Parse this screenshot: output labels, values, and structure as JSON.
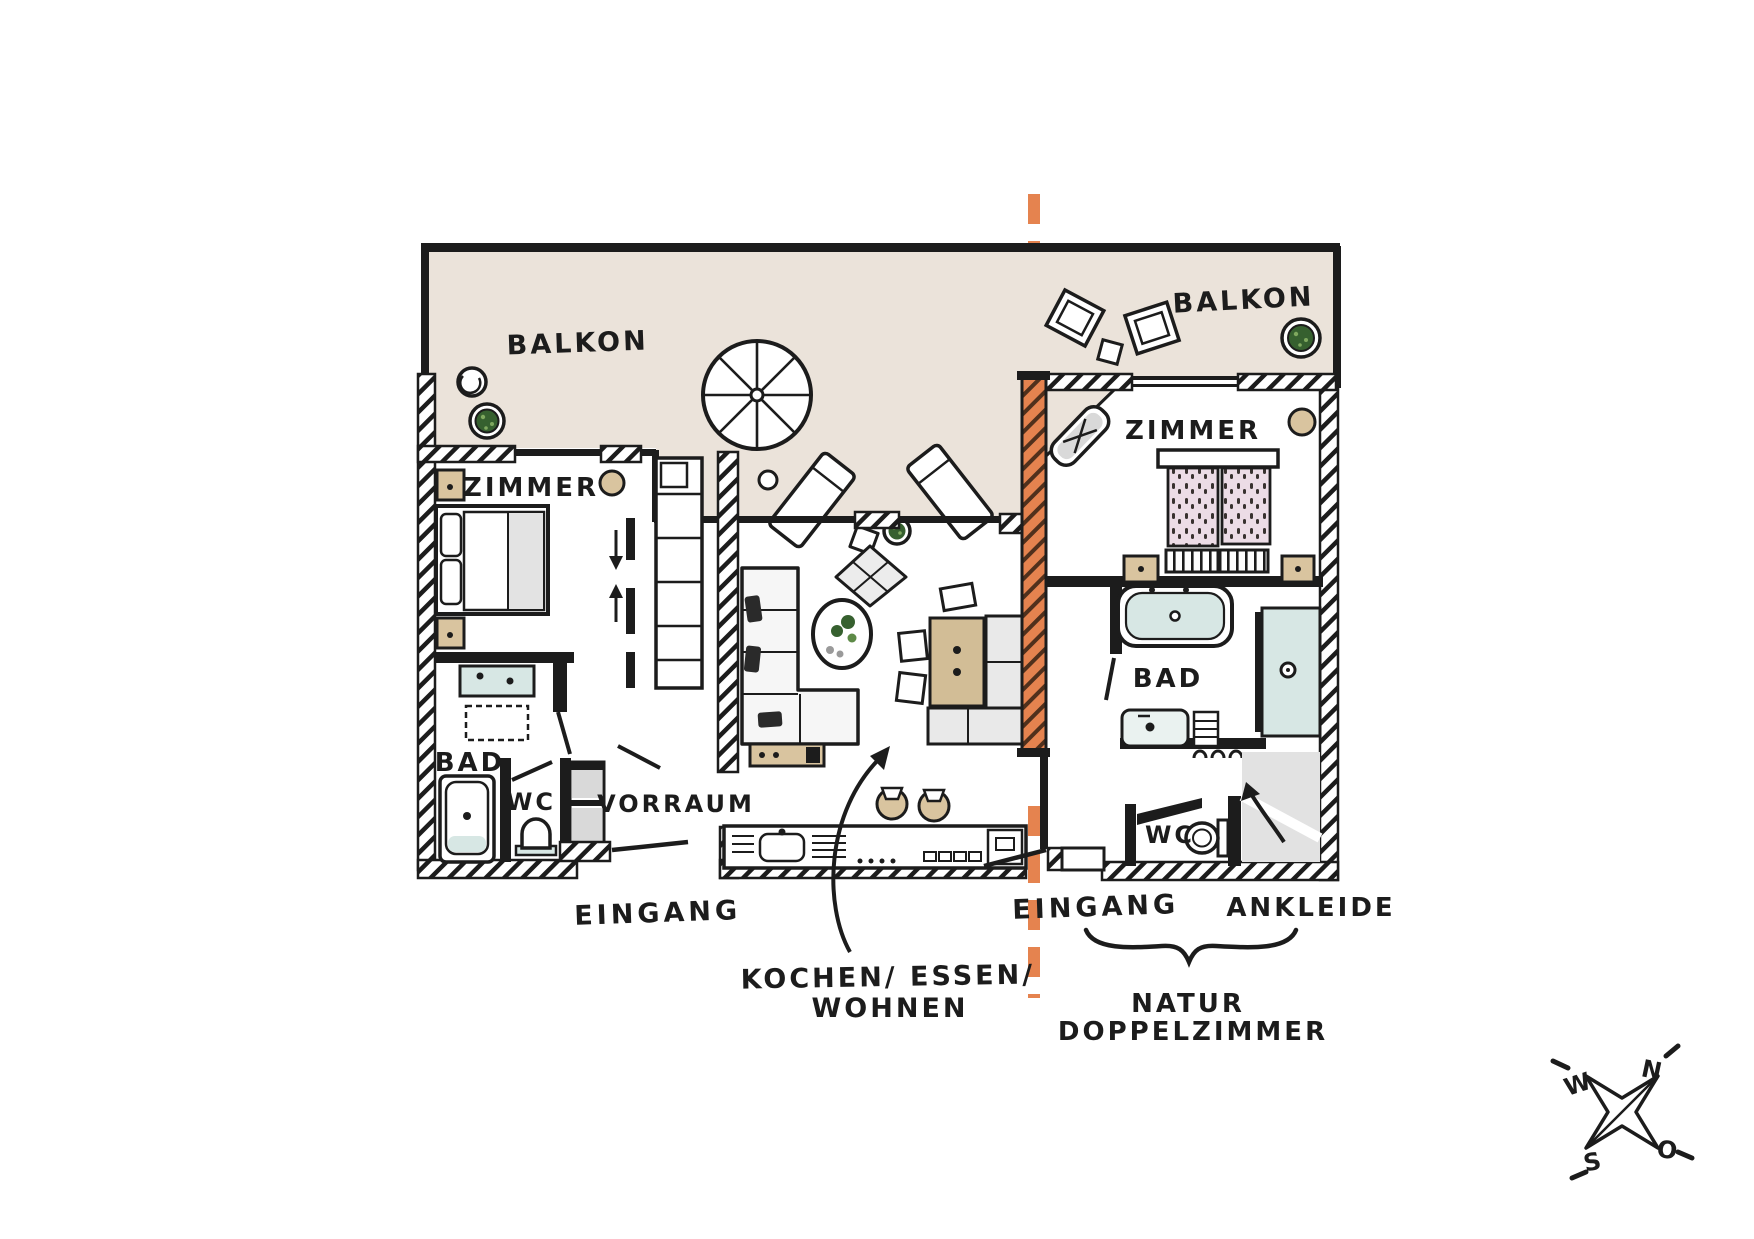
{
  "diagram": {
    "units": {
      "left": {
        "balcony_label": "BALKON",
        "bedroom_label": "ZIMMER",
        "bath_label": "BAD",
        "wc_label": "WC",
        "hall_label": "VORRAUM",
        "entrance_label": "EINGANG",
        "living_label_lines": [
          "KOCHEN/ ESSEN/",
          "WOHNEN"
        ]
      },
      "right": {
        "balcony_label": "BALKON",
        "bedroom_label": "ZIMMER",
        "bath_label": "BAD",
        "wc_label": "WC",
        "entrance_label": "EINGANG",
        "dressing_label": "ANKLEIDE",
        "unit_name_lines": [
          "NATUR",
          "DOPPELZIMMER"
        ]
      }
    },
    "compass": {
      "north": "N",
      "east": "O",
      "south": "S",
      "west": "W"
    },
    "colors": {
      "background": "#ffffff",
      "balcony_floor": "#ebe3da",
      "wall_ink": "#1c1c1c",
      "divider_orange": "#e5834f",
      "water_blue": "#d7e7e4",
      "wood_beige": "#d9c49f",
      "plant_green": "#36602f",
      "mattress_pink": "#ecdce6",
      "furniture_gray": "#e9e9e9"
    }
  }
}
